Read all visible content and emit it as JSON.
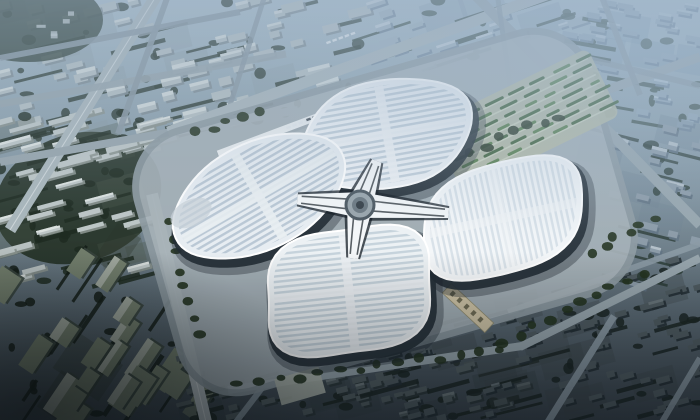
{
  "scene": {
    "type": "architectural-aerial-rendering",
    "subject": "four-leaf-clover exhibition and convention center surrounded by city blocks"
  },
  "seed": 7,
  "colors": {
    "bg_stops": [
      [
        0,
        "#abbeca"
      ],
      [
        0.2,
        "#95a9b5"
      ],
      [
        0.45,
        "#7f919c"
      ],
      [
        0.7,
        "#5f6e78"
      ],
      [
        1,
        "#39434b"
      ]
    ],
    "road_main": "#a9b6bb",
    "road_mid": "#97a5ac",
    "road_dim": "#8a99a3",
    "road_bright": "#b6bfc3",
    "lane": "#e8ecee",
    "plaza": "#a7b2b8",
    "plaza_ring": "#8e9ba2",
    "podium": "#222c34",
    "podium_soft": "#1a232a",
    "rim": "#ffffff",
    "hub_white": "#f3f6f8",
    "hub_glass": "#161e25",
    "hub_disc": "#9aa6ad",
    "hub_ring": "#4e5a63",
    "hub_inner": "#6d7a83",
    "hub_core": "#39434b",
    "parking_base": "#b5bba4",
    "parking_row_light": "#cdd4bf",
    "parking_green_a": "#3f6138",
    "parking_green_b": "#557d48",
    "gate": "#cdc2a4",
    "gate_edge": "#8f8b6e",
    "gate_dot": "#6e6a52",
    "overpass": "#e9edef",
    "overpass_shade": "#9aa6ad",
    "bus_dark": "#434d55",
    "bus_light": "#e4e9ec",
    "tree_site": "#24331f",
    "lot_west": "#b3bab0",
    "corner_trees": "#2e3d33",
    "haze_top": "154,176,198",
    "haze_tr": "168,192,214",
    "vignette": "10,16,22"
  },
  "plaza": {
    "cx": 385,
    "cy": 212,
    "w": 470,
    "h": 270,
    "rot": -16,
    "margin": 12
  },
  "petals": [
    {
      "id": "north",
      "cx": 387,
      "cy": 134,
      "rx": 84,
      "ry": 52,
      "rot": -14,
      "stripe_angle": -10,
      "base": "#eef2f6",
      "stripe": "#c2cfda",
      "band": "#eef2f5",
      "band_op": 0.9,
      "m": 2.6,
      "lobe": 0.05,
      "phase": 0.6
    },
    {
      "id": "west",
      "cx": 259,
      "cy": 196,
      "rx": 89,
      "ry": 51,
      "rot": -27,
      "stripe_angle": -30,
      "base": "#e7edf2",
      "stripe": "#bac8d5",
      "band": "#e9eef2",
      "band_op": 0.9,
      "m": 2.6,
      "lobe": 0.05,
      "phase": 0.1,
      "tip": {
        "x": 191,
        "y": 213,
        "rx": 22,
        "ry": 13,
        "fill": "#c9d2d8",
        "op": 0.7
      }
    },
    {
      "id": "east",
      "cx": 503,
      "cy": 218,
      "rx": 84,
      "ry": 54,
      "rot": -24,
      "stripe_angle": 78,
      "base": "#f4f7f9",
      "stripe": "#d9e2e9",
      "band": "#f2f5f7",
      "band_op": 0.6,
      "m": 2.6,
      "lobe": 0.05,
      "phase": 1.2
    },
    {
      "id": "south",
      "cx": 349,
      "cy": 291,
      "rx": 85,
      "ry": 63,
      "rot": -16,
      "stripe_angle": -6,
      "base": "#ecf1f4",
      "stripe": "#c6d3dc",
      "band": "#edf1f4",
      "band_op": 0.85,
      "m": 2.6,
      "lobe": 0.06,
      "phase": 1.9
    }
  ],
  "hub": {
    "cx": 360,
    "cy": 205,
    "arm_len_factor": 0.62,
    "arm_w0": 13,
    "arm_w1": 5
  },
  "roads": [
    [
      10,
      230,
      160,
      -10,
      12,
      "road_main",
      1,
      "lane"
    ],
    [
      0,
      162,
      298,
      110,
      8,
      "road_mid",
      1,
      ""
    ],
    [
      0,
      104,
      286,
      54,
      7,
      "road_mid",
      0.9,
      ""
    ],
    [
      0,
      58,
      240,
      12,
      6,
      "road_dim",
      0.9,
      ""
    ],
    [
      118,
      134,
      170,
      -10,
      6,
      "road_dim",
      0.9,
      ""
    ],
    [
      224,
      124,
      266,
      -8,
      5,
      "road_dim",
      0.85,
      ""
    ],
    [
      168,
      132,
      560,
      -10,
      11,
      "road_main",
      1,
      ""
    ],
    [
      375,
      172,
      700,
      57,
      9,
      "road_mid",
      1,
      ""
    ],
    [
      470,
      -10,
      700,
      225,
      10,
      "road_mid",
      1,
      ""
    ],
    [
      497,
      -8,
      512,
      100,
      5,
      "road_dim",
      0.85,
      ""
    ],
    [
      600,
      -8,
      640,
      95,
      6,
      "road_dim",
      0.9,
      ""
    ],
    [
      560,
      52,
      700,
      86,
      6,
      "road_dim",
      0.8,
      ""
    ],
    [
      152,
      194,
      206,
      422,
      12,
      "road_bright",
      1,
      "lane"
    ],
    [
      228,
      390,
      522,
      346,
      8,
      "road_mid",
      1,
      ""
    ],
    [
      520,
      347,
      700,
      258,
      8,
      "road_mid",
      1,
      ""
    ],
    [
      508,
      312,
      700,
      244,
      6,
      "road_dim",
      0.9,
      ""
    ],
    [
      548,
      422,
      614,
      316,
      7,
      "road_dim",
      0.95,
      ""
    ],
    [
      662,
      422,
      700,
      358,
      6,
      "road_dim",
      0.9,
      ""
    ],
    [
      236,
      422,
      262,
      388,
      6,
      "road_dim",
      0.9,
      ""
    ]
  ],
  "districts": [
    {
      "name": "north-city",
      "x": 0,
      "y": 0,
      "w": 360,
      "h": 158,
      "angle": -14,
      "building": "#b4bfc2",
      "shade": "#7f8d93",
      "roof": "#d4dbdc",
      "tree": "#2b3930",
      "base": "#8d9aa1",
      "count": 85,
      "tcount": 70,
      "bw": [
        10,
        24
      ],
      "bh": [
        5,
        9
      ],
      "hl": 0.45
    },
    {
      "name": "northeast-city",
      "x": 352,
      "y": 0,
      "w": 230,
      "h": 150,
      "angle": -18,
      "building": "#a0b2be",
      "shade": "#74889b",
      "roof": "#c6d2da",
      "tree": "#37493f",
      "base": "#7e93a4",
      "count": 55,
      "tcount": 38,
      "bw": [
        8,
        20
      ],
      "bh": [
        4,
        8
      ],
      "hl": 0.4
    },
    {
      "name": "topright-city",
      "x": 565,
      "y": 0,
      "w": 135,
      "h": 135,
      "angle": 10,
      "building": "#93a7b6",
      "shade": "#6d8296",
      "roof": "#b7c6d2",
      "tree": "#3a4c44",
      "base": "#7490a4",
      "count": 34,
      "tcount": 22,
      "bw": [
        8,
        18
      ],
      "bh": [
        4,
        7
      ],
      "hl": 0.35
    },
    {
      "name": "west-estate",
      "x": 0,
      "y": 112,
      "w": 162,
      "h": 170,
      "angle": -15,
      "building": "#bdc6c6",
      "shade": "#8a948f",
      "roof": "#dfe4e2",
      "tree": "#1f2b21",
      "base": "#4a584c",
      "count": 40,
      "tcount": 58,
      "bw": [
        18,
        34
      ],
      "bh": [
        4,
        6
      ],
      "hl": 0.25
    },
    {
      "name": "southwest-industrial",
      "x": 0,
      "y": 244,
      "w": 235,
      "h": 176,
      "angle": -56,
      "building": "#75816f",
      "shade": "#39453e",
      "roof": "#a8afa6",
      "tree": "#141d17",
      "base": "#2a342c",
      "count": 22,
      "tcount": 40,
      "bw": [
        20,
        44
      ],
      "bh": [
        12,
        26
      ],
      "hl": 0.3
    },
    {
      "name": "south-city",
      "x": 180,
      "y": 356,
      "w": 345,
      "h": 64,
      "angle": -14,
      "building": "#525e61",
      "shade": "#2b3639",
      "roof": "#707c80",
      "tree": "#1a2420",
      "base": "#323d40",
      "count": 55,
      "tcount": 28,
      "bw": [
        8,
        16
      ],
      "bh": [
        4,
        7
      ],
      "hl": 0.2
    },
    {
      "name": "southeast-city",
      "x": 382,
      "y": 260,
      "w": 318,
      "h": 160,
      "angle": -15,
      "building": "#4e5a5f",
      "shade": "#242f34",
      "roof": "#6b777c",
      "tree": "#1a2522",
      "base": "#3a4549",
      "count": 95,
      "tcount": 52,
      "bw": [
        8,
        16
      ],
      "bh": [
        4,
        7
      ],
      "hl": 0.2
    },
    {
      "name": "east-mid",
      "x": 582,
      "y": 128,
      "w": 118,
      "h": 160,
      "angle": 14,
      "building": "#8b9aa6",
      "shade": "#5f7181",
      "roof": "#b8c4cc",
      "tree": "#2c3c36",
      "base": "#6e8090",
      "count": 26,
      "tcount": 26,
      "bw": [
        8,
        18
      ],
      "bh": [
        4,
        8
      ],
      "hl": 0.3
    }
  ],
  "tree_rows": [
    [
      240,
      384,
      500,
      350,
      14
    ],
    [
      505,
      342,
      642,
      274,
      10
    ],
    [
      592,
      252,
      652,
      218,
      6
    ],
    [
      424,
      168,
      560,
      116,
      10
    ],
    [
      198,
      132,
      258,
      114,
      5
    ],
    [
      166,
      222,
      202,
      334,
      8
    ]
  ],
  "parking": {
    "cx": 525,
    "cy": 120,
    "w": 175,
    "h": 75,
    "rot": -26,
    "rows": 7,
    "row_gap": 9
  },
  "gate": {
    "cx": 468,
    "cy": 308,
    "w": 13,
    "len": 58,
    "rot": -47
  },
  "lot_west": {
    "cx": 300,
    "cy": 386,
    "w": 46,
    "h": 27,
    "rot": -16
  },
  "overpass": {
    "x1": 218,
    "y1": 154,
    "x2": 330,
    "y2": 112,
    "w": 7
  },
  "bus_rows": [
    {
      "x": 286,
      "y": 127,
      "angle": -20,
      "n": 6,
      "kind": "light"
    },
    {
      "x": 306,
      "y": 119,
      "angle": -20,
      "n": 4,
      "kind": "dark"
    },
    {
      "x": 326,
      "y": 42,
      "angle": -20,
      "n": 5,
      "kind": "light"
    }
  ],
  "corner_grove": {
    "cx": 28,
    "cy": 20,
    "rx": 75,
    "ry": 42
  }
}
